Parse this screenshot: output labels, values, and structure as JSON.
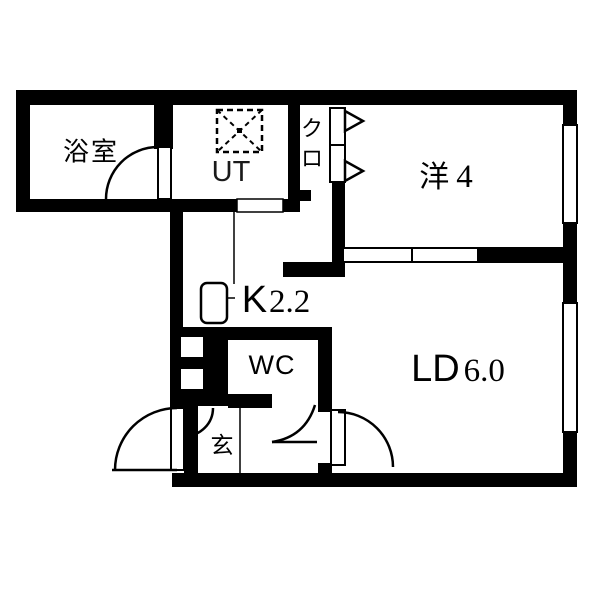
{
  "title": "1LDK apartment floor plan",
  "colors": {
    "wall": "#000000",
    "floor": "#ffffff",
    "line": "#000000"
  },
  "canvas": {
    "w": 600,
    "h": 600
  },
  "labels": {
    "bath": {
      "text": "浴室"
    },
    "utility": {
      "text": "UT"
    },
    "closet": {
      "text": "クロ"
    },
    "western": {
      "jp": "洋",
      "num": "4"
    },
    "kitchen": {
      "jp": "K",
      "num": "2.2"
    },
    "wc": {
      "text": "WC"
    },
    "living": {
      "jp": "LD",
      "num": "6.0"
    },
    "entrance": {
      "text": "玄"
    }
  },
  "walls": [
    {
      "name": "top-wall",
      "x": 16,
      "y": 90,
      "w": 561,
      "h": 15
    },
    {
      "name": "left-wall-upper",
      "x": 16,
      "y": 90,
      "w": 14,
      "h": 122
    },
    {
      "name": "bath-bottom-wall",
      "x": 16,
      "y": 199,
      "w": 169,
      "h": 13
    },
    {
      "name": "bath-ut-divider",
      "x": 154,
      "y": 105,
      "w": 19,
      "h": 44
    },
    {
      "name": "ut-closet-divider",
      "x": 288,
      "y": 105,
      "w": 12,
      "h": 107
    },
    {
      "name": "ut-bottom-wall-left",
      "x": 173,
      "y": 199,
      "w": 64,
      "h": 13
    },
    {
      "name": "ut-bottom-wall-right",
      "x": 283,
      "y": 199,
      "w": 17,
      "h": 13
    },
    {
      "name": "closet-right-wall",
      "x": 332,
      "y": 182,
      "w": 13,
      "h": 95
    },
    {
      "name": "closet-corner-block",
      "x": 300,
      "y": 190,
      "w": 11,
      "h": 11
    },
    {
      "name": "kitchen-upper-wall",
      "x": 283,
      "y": 262,
      "w": 62,
      "h": 15
    },
    {
      "name": "partition-wall-right",
      "x": 478,
      "y": 247,
      "w": 85,
      "h": 16
    },
    {
      "name": "right-wall-top",
      "x": 563,
      "y": 90,
      "w": 14,
      "h": 35
    },
    {
      "name": "right-wall-mid",
      "x": 563,
      "y": 223,
      "w": 14,
      "h": 80
    },
    {
      "name": "right-wall-bottom",
      "x": 563,
      "y": 432,
      "w": 14,
      "h": 55
    },
    {
      "name": "left-wall-lower",
      "x": 170,
      "y": 212,
      "w": 13,
      "h": 115
    },
    {
      "name": "wc-top-wall",
      "x": 170,
      "y": 327,
      "w": 162,
      "h": 13
    },
    {
      "name": "shoe-cabinet",
      "x": 170,
      "y": 327,
      "w": 58,
      "h": 79
    },
    {
      "name": "wc-bottom-wall",
      "x": 228,
      "y": 394,
      "w": 44,
      "h": 14
    },
    {
      "name": "ld-left-wall-upper",
      "x": 318,
      "y": 327,
      "w": 14,
      "h": 85
    },
    {
      "name": "ld-left-wall-lower",
      "x": 318,
      "y": 463,
      "w": 14,
      "h": 10
    },
    {
      "name": "entrance-left-wall",
      "x": 184,
      "y": 403,
      "w": 14,
      "h": 70
    },
    {
      "name": "entrance-top-patch",
      "x": 170,
      "y": 398,
      "w": 28,
      "h": 10
    },
    {
      "name": "bottom-wall",
      "x": 172,
      "y": 473,
      "w": 405,
      "h": 14
    }
  ],
  "floor_cutouts": [
    {
      "name": "shoe-cabinet-cell-1",
      "x": 181,
      "y": 337,
      "w": 22,
      "h": 20
    },
    {
      "name": "shoe-cabinet-cell-2",
      "x": 181,
      "y": 369,
      "w": 22,
      "h": 20
    }
  ],
  "windows": [
    {
      "name": "window-western-room",
      "x": 563,
      "y": 125,
      "w": 14,
      "h": 98,
      "stroke": 2
    },
    {
      "name": "window-living",
      "x": 563,
      "y": 303,
      "w": 14,
      "h": 129,
      "stroke": 2
    }
  ],
  "panels": [
    {
      "name": "sliding-door-panel-1",
      "x": 343,
      "y": 248,
      "w": 69,
      "h": 14,
      "stroke": 2
    },
    {
      "name": "sliding-door-panel-2",
      "x": 412,
      "y": 248,
      "w": 66,
      "h": 14,
      "stroke": 2
    },
    {
      "name": "closet-door-panel-1",
      "x": 330,
      "y": 108,
      "w": 15,
      "h": 37,
      "stroke": 2
    },
    {
      "name": "closet-door-panel-2",
      "x": 330,
      "y": 145,
      "w": 15,
      "h": 37,
      "stroke": 2
    },
    {
      "name": "bath-door-leaf",
      "x": 158,
      "y": 147,
      "w": 13,
      "h": 52,
      "stroke": 2
    },
    {
      "name": "entrance-door-leaf",
      "x": 171,
      "y": 408,
      "w": 13,
      "h": 62,
      "stroke": 2
    },
    {
      "name": "ld-door-leaf",
      "x": 331,
      "y": 410,
      "w": 14,
      "h": 55,
      "stroke": 2
    },
    {
      "name": "ut-opening",
      "x": 237,
      "y": 199,
      "w": 46,
      "h": 13,
      "stroke": 1.5
    }
  ],
  "arcs": [
    {
      "name": "bath-door-arc",
      "d": "M 106,199 A 52,52 0 0 1 158,147"
    },
    {
      "name": "entrance-door-arc",
      "d": "M 177,408 A 62,62 0 0 0 115,470"
    },
    {
      "name": "entrance-inner-arc",
      "d": "M 213,408 A 28,28 0 0 1 185,436"
    },
    {
      "name": "wc-door-arc",
      "d": "M 272,442 Q 305,437 315,405"
    },
    {
      "name": "ld-door-arc",
      "d": "M 338,412 A 55,55 0 0 1 393,467"
    }
  ],
  "lines": [
    {
      "name": "kitchen-counter-line",
      "x1": 234,
      "y1": 212,
      "x2": 234,
      "y2": 284,
      "w": 1.5
    },
    {
      "name": "entrance-step-line",
      "x1": 240,
      "y1": 408,
      "x2": 240,
      "y2": 473,
      "w": 1.5
    },
    {
      "name": "entrance-door-open-line",
      "x1": 112,
      "y1": 470,
      "x2": 177,
      "y2": 470,
      "w": 2.5
    },
    {
      "name": "wc-door-open-line",
      "x1": 272,
      "y1": 442,
      "x2": 317,
      "y2": 442,
      "w": 2.5
    },
    {
      "name": "sink-faucet-tick",
      "x1": 228,
      "y1": 298,
      "x2": 235,
      "y2": 298,
      "w": 1.5
    }
  ],
  "triangles": [
    {
      "name": "closet-fold-arrow-1",
      "points": "345,111 345,131 363,121"
    },
    {
      "name": "closet-fold-arrow-2",
      "points": "345,161 345,181 363,171"
    }
  ],
  "washer": {
    "name": "washer-pan",
    "x": 217,
    "y": 110,
    "w": 45,
    "h": 42,
    "box_dash": "6,4",
    "diag_dash": "5,4",
    "dot": {
      "x": 237,
      "y": 128,
      "w": 5,
      "h": 5
    }
  },
  "sink": {
    "name": "kitchen-sink",
    "x": 201,
    "y": 283,
    "w": 26,
    "h": 40,
    "rx": 6,
    "stroke": 2.5
  }
}
